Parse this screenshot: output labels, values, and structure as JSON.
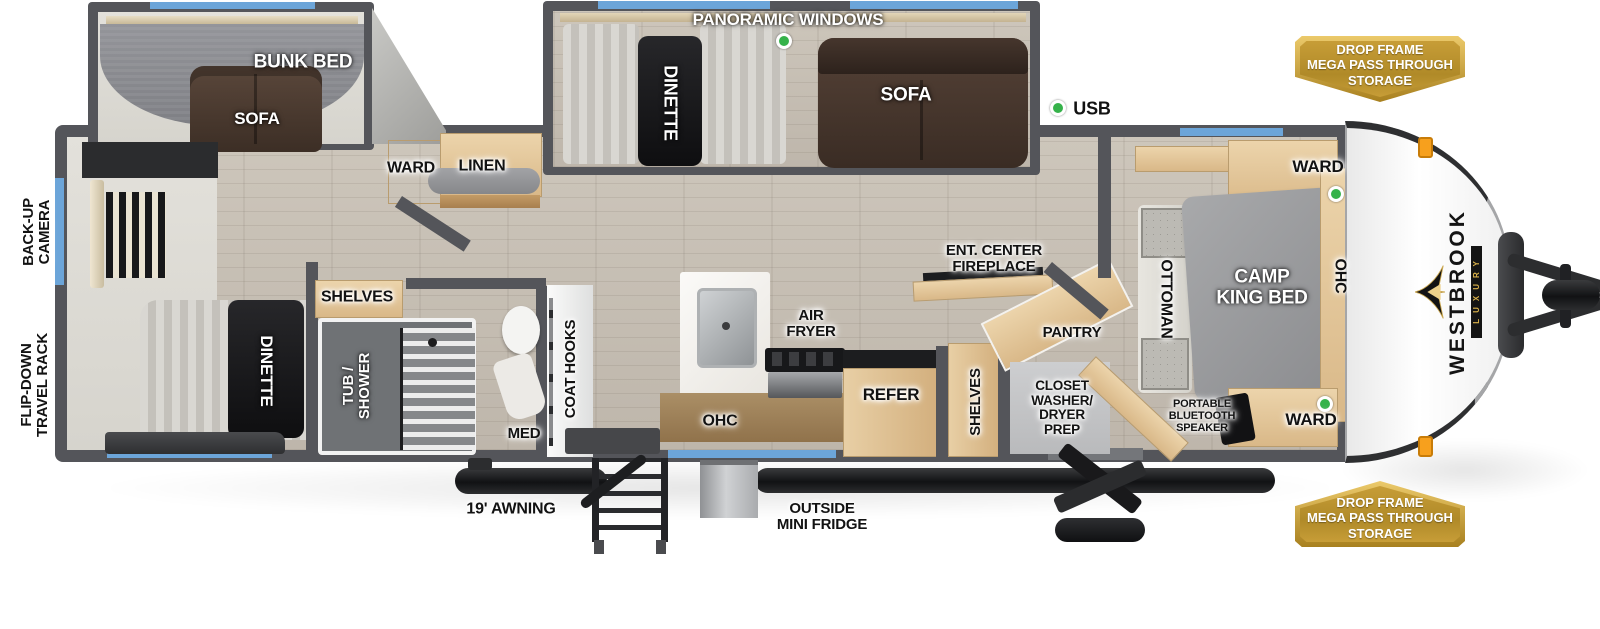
{
  "colors": {
    "wall": "#54555a",
    "window": "#6ca5d9",
    "green": "#35b24a",
    "wood": "#e2c folder"
  },
  "brand": {
    "name": "WESTBROOK",
    "tagline": "LUXURY"
  },
  "badges": {
    "pass_through": "DROP FRAME\nMEGA PASS THROUGH\nSTORAGE"
  },
  "exterior": {
    "usb": "USB",
    "backup_camera": "BACK-UP\nCAMERA",
    "travel_rack": "FLIP-DOWN\nTRAVEL RACK",
    "awning": "19' AWNING",
    "mini_fridge": "OUTSIDE\nMINI FRIDGE"
  },
  "bunk_room": {
    "bunk_bed": "BUNK BED",
    "sofa": "SOFA"
  },
  "living_slide": {
    "windows": "PANORAMIC WINDOWS",
    "dinette": "DINETTE",
    "sofa": "SOFA"
  },
  "storage": {
    "ward": "WARD",
    "linen": "LINEN",
    "shelves": "SHELVES",
    "pantry": "PANTRY",
    "ohc": "OHC"
  },
  "rear_room": {
    "dinette": "DINETTE"
  },
  "bath": {
    "tub_shower": "TUB /\nSHOWER",
    "med": "MED",
    "coat_hooks": "COAT HOOKS"
  },
  "kitchen": {
    "air_fryer": "AIR\nFRYER",
    "refer": "REFER",
    "ent_center": "ENT. CENTER\nFIREPLACE"
  },
  "utility": {
    "closet": "CLOSET\nWASHER/\nDRYER\nPREP"
  },
  "bedroom": {
    "bed": "CAMP\nKING BED",
    "ottoman": "OTTOMAN",
    "ohc": "OHC",
    "speaker": "PORTABLE\nBLUETOOTH\nSPEAKER"
  }
}
